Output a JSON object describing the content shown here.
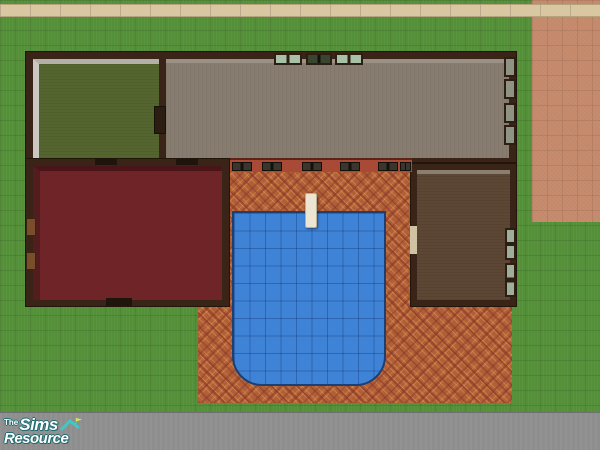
{
  "watermark": {
    "prefix": "The",
    "brand": "Sims",
    "suffix": "Resource",
    "text_color": "#ffffff",
    "outline_color": "#1e6b70",
    "roof_icon_color": "#3fc8c4"
  },
  "palette": {
    "grass": "#549038",
    "sidewalk": "#d9c7a2",
    "dirt_path": "#c4886a",
    "street": "#8e8e8e",
    "house_wall": "#3a2418",
    "patio_tile": "#b06038",
    "patio_tile_accent": "#8c3326",
    "pool_water": "#3f83d6",
    "pool_border": "#1d3f72",
    "diving_board": "#ece5d2",
    "window_glass": "#a9c0a8",
    "window_frame": "#2c1f12",
    "patio_wall": "#a84a36"
  },
  "scene": {
    "view": "top-down lot overview",
    "rooms": [
      {
        "name": "green-room",
        "floor_color": "#55652f"
      },
      {
        "name": "tan-room",
        "floor_color": "#877c6f"
      },
      {
        "name": "red-room",
        "floor_color": "#6f2427"
      },
      {
        "name": "brown-room",
        "floor_color": "#5c4634"
      }
    ],
    "pool": {
      "shape": "rectangle with rounded bottom corners",
      "water_color": "#3f83d6",
      "has_diving_board": true
    }
  }
}
